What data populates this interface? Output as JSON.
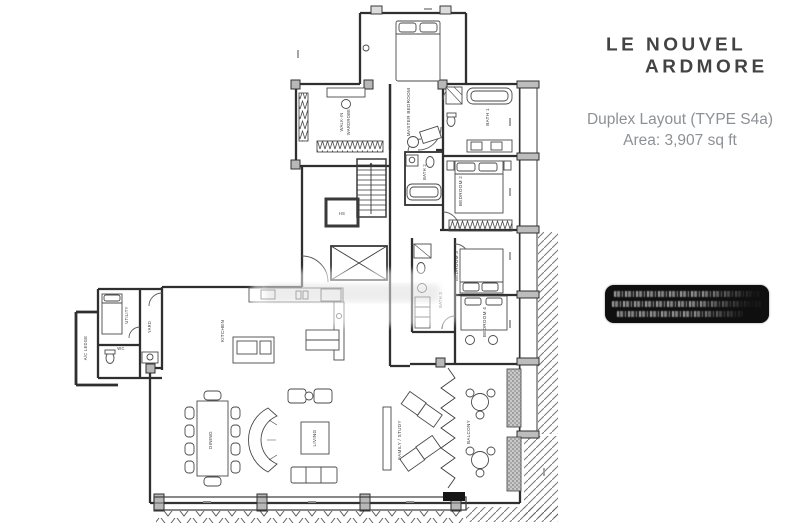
{
  "brand": {
    "line1": "LE NOUVEL",
    "line2": "ARDMORE"
  },
  "header": {
    "title": "Duplex Layout (TYPE S4a)",
    "area": "Area: 3,907 sq ft"
  },
  "colors": {
    "logo_text": "#434346",
    "subtitle_text": "#8d9195",
    "badge_bg": "#0f0f0f",
    "wall": "#2f2f2f"
  },
  "plan": {
    "labels": {
      "master_bedroom": "MASTER BEDROOM",
      "walk_in_l1": "WALK-IN",
      "walk_in_l2": "WARDROBE",
      "bath1": "BATH 1",
      "bath2": "BATH 2",
      "bedroom2": "BEDROOM 2",
      "bedroom3": "BEDROOM 3",
      "bath3": "BATH 3",
      "bedroom4": "BEDROOM 4",
      "hs": "HS",
      "kitchen": "KITCHEN",
      "yard": "YARD",
      "utility": "UTILITY",
      "wc": "WC",
      "ac_ledge": "A/C LEDGE",
      "dining": "DINING",
      "living": "LIVING",
      "family_study": "FAMILY / STUDY",
      "balcony": "BALCONY"
    }
  }
}
